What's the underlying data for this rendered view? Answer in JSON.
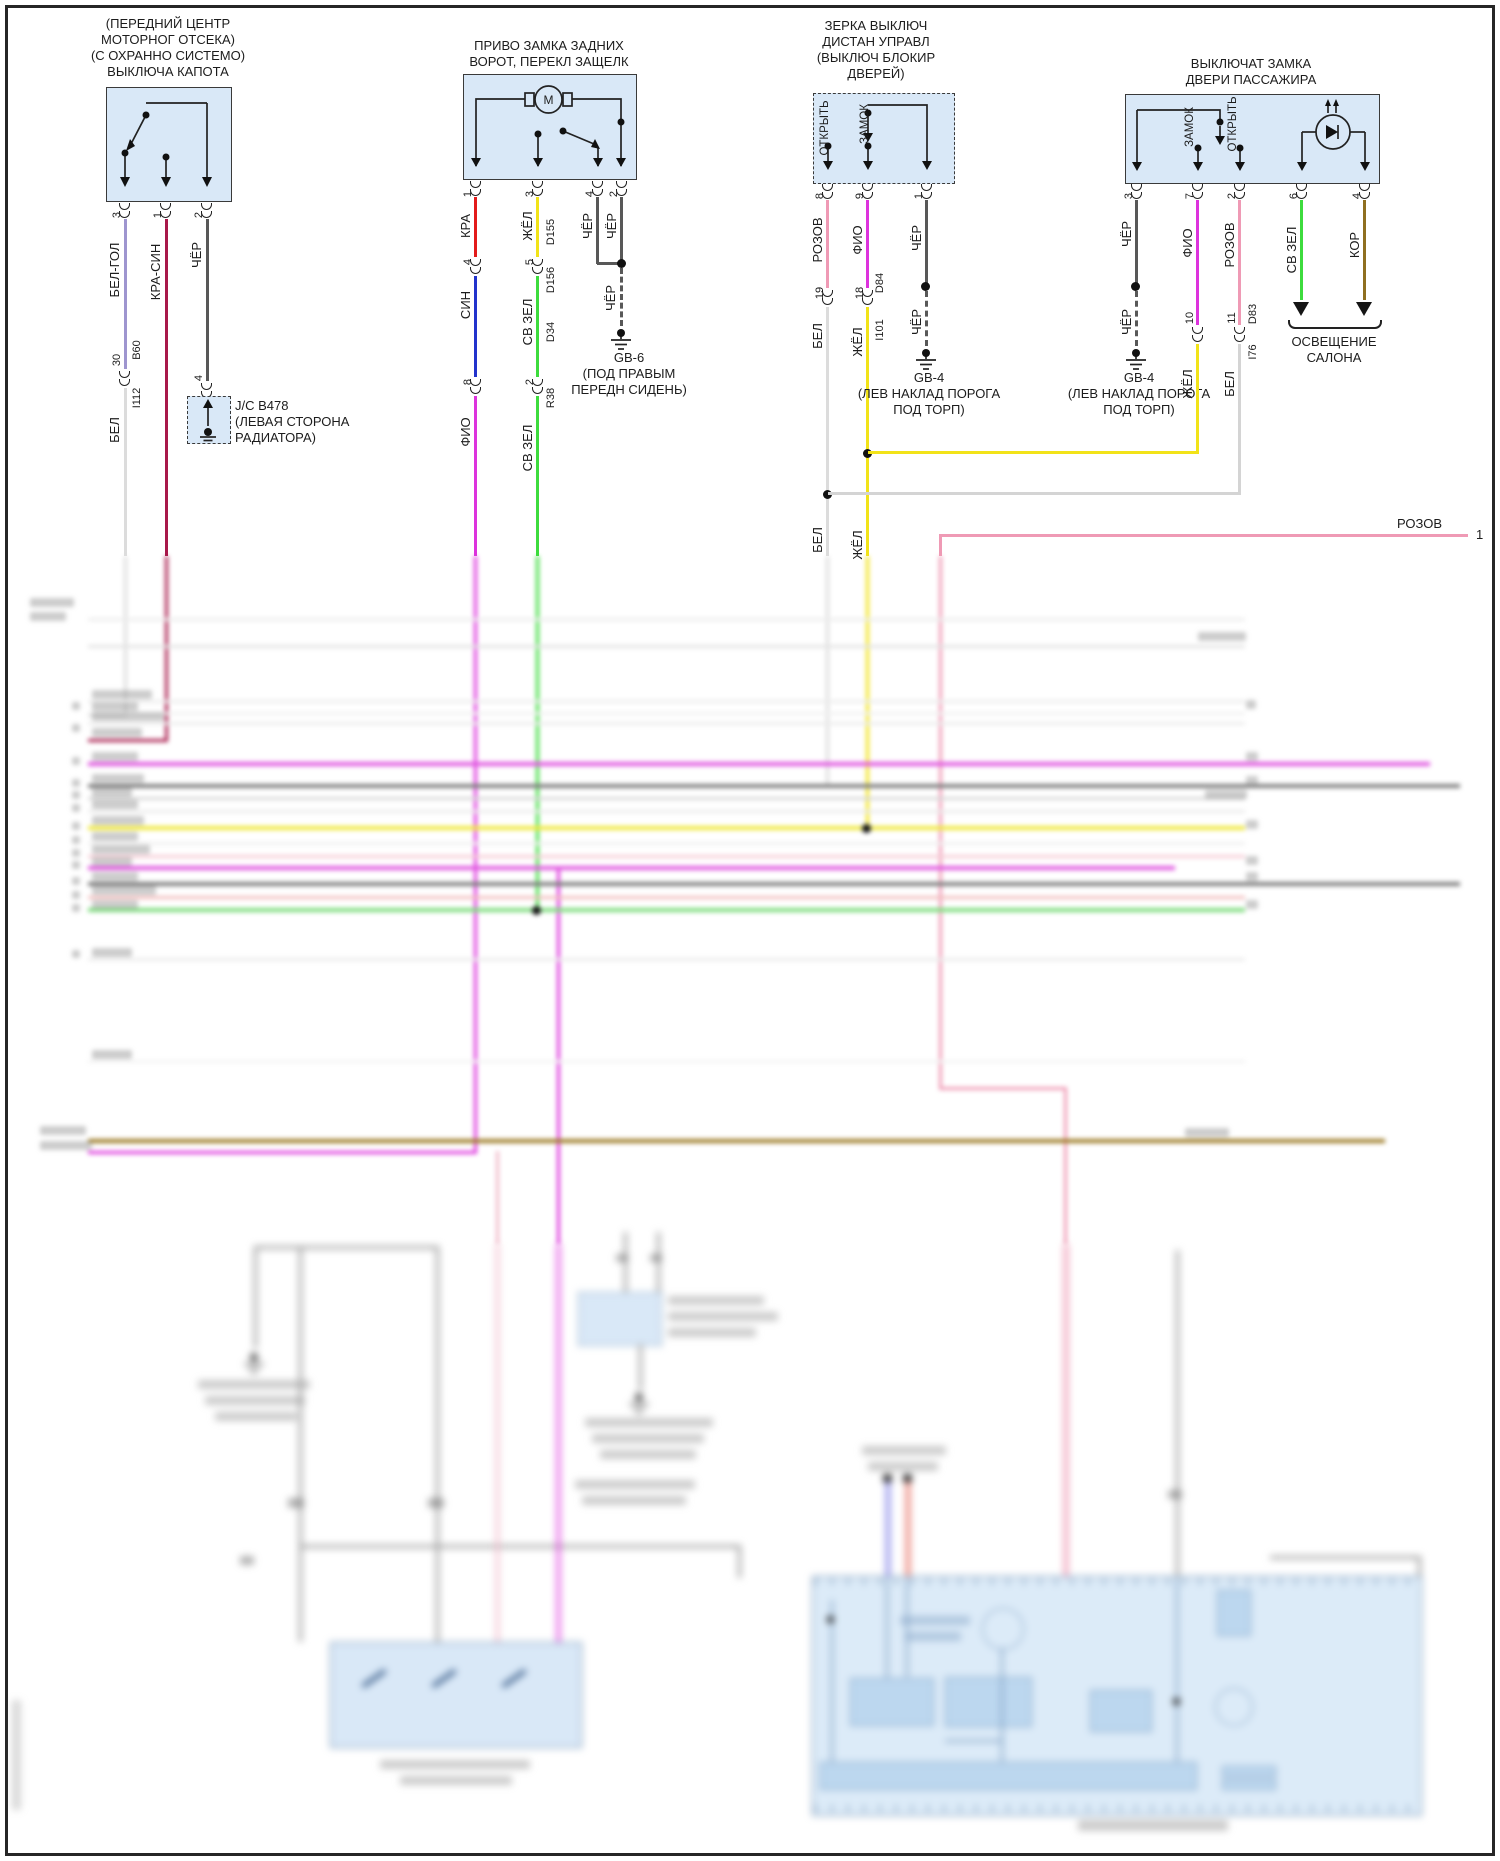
{
  "page": {
    "bg": "#ffffff",
    "frame_color": "#262626",
    "block_fill": "#d9e8f7"
  },
  "colors": {
    "bel_gol": "#9e95cf",
    "kra_sin": "#a8184a",
    "cher": "#585858",
    "bel": "#dcdcdc",
    "kra": "#e31b1b",
    "zhel": "#f2e318",
    "sin": "#2233cc",
    "sv_zel": "#3ddc3d",
    "fio": "#dd33dd",
    "rozov": "#ef9ab5",
    "kor": "#8f6f20"
  },
  "b1": {
    "t": [
      "(ПЕРЕДНИЙ ЦЕНТР",
      "МОТОРНОГ ОТСЕКА)",
      "(С ОХРАННО СИСТЕМО)",
      "ВЫКЛЮЧА КАПОТА"
    ],
    "pins": [
      "3",
      "1",
      "2"
    ],
    "w": [
      "БЕЛ-ГОЛ",
      "КРА-СИН",
      "ЧЁР"
    ],
    "s30": "30",
    "b60": "B60",
    "i112": "I112",
    "bel": "БЕЛ",
    "p4": "4",
    "jc": [
      "J/C B478",
      "(ЛЕВАЯ СТОРОНА",
      "РАДИАТОРА)"
    ]
  },
  "b2": {
    "t": [
      "ПРИВО ЗАМКА ЗАДНИХ",
      "ВОРОТ, ПЕРЕКЛ ЗАЩЕЛК"
    ],
    "m": "M",
    "pins": [
      "1",
      "3",
      "4",
      "2"
    ],
    "w": [
      "КРА",
      "ЖЁЛ",
      "ЧЁР",
      "ЧЁР"
    ],
    "d155": "D155",
    "p4": "4",
    "sin": "СИН",
    "p5": "5",
    "d156": "D156",
    "svzel": "СВ ЗЕЛ",
    "d34": "D34",
    "p8": "8",
    "fio": "ФИО",
    "p2": "2",
    "r38": "R38",
    "svzel2": "СВ ЗЕЛ",
    "cher": "ЧЁР",
    "gnd": [
      "GB-6",
      "(ПОД ПРАВЫМ",
      "ПЕРЕДН СИДЕНЬ)"
    ]
  },
  "b3": {
    "t": [
      "ЗЕРКА ВЫКЛЮЧ",
      "ДИСТАН УПРАВЛ",
      "(ВЫКЛЮЧ БЛОКИР",
      "ДВЕРЕЙ)"
    ],
    "open": "ОТКРЫТЬ",
    "lock": "ЗАМОК",
    "pins": [
      "8",
      "9",
      "1"
    ],
    "w": [
      "РОЗОВ",
      "ФИО",
      "ЧЁР"
    ],
    "p19": "19",
    "p18": "18",
    "d84": "D84",
    "i101": "I101",
    "bel": "БЕЛ",
    "zhel": "ЖЁЛ",
    "cher": "ЧЁР",
    "bel2": "БЕЛ",
    "zhel2": "ЖЁЛ",
    "gnd": [
      "GB-4",
      "(ЛЕВ НАКЛАД ПОРОГА",
      "ПОД ТОРП)"
    ]
  },
  "b4": {
    "t": [
      "ВЫКЛЮЧАТ ЗАМКА",
      "ДВЕРИ ПАССАЖИРА"
    ],
    "lock": "ЗАМОК",
    "open": "ОТКРЫТЬ",
    "pins": [
      "3",
      "7",
      "2",
      "6",
      "4"
    ],
    "w": [
      "ЧЁР",
      "ФИО",
      "РОЗОВ",
      "СВ ЗЕЛ",
      "КОР"
    ],
    "p10": "10",
    "zhel": "ЖЁЛ",
    "p11": "11",
    "d83": "D83",
    "i76": "I76",
    "bel": "БЕЛ",
    "cher": "ЧЁР",
    "gnd": [
      "GB-4",
      "(ЛЕВ НАКЛАД ПОРОГА",
      "ПОД ТОРП)"
    ],
    "light": [
      "ОСВЕЩЕНИЕ",
      "САЛОНА"
    ]
  },
  "bus": {
    "rozov": "РОЗОВ",
    "pin1": "1"
  }
}
